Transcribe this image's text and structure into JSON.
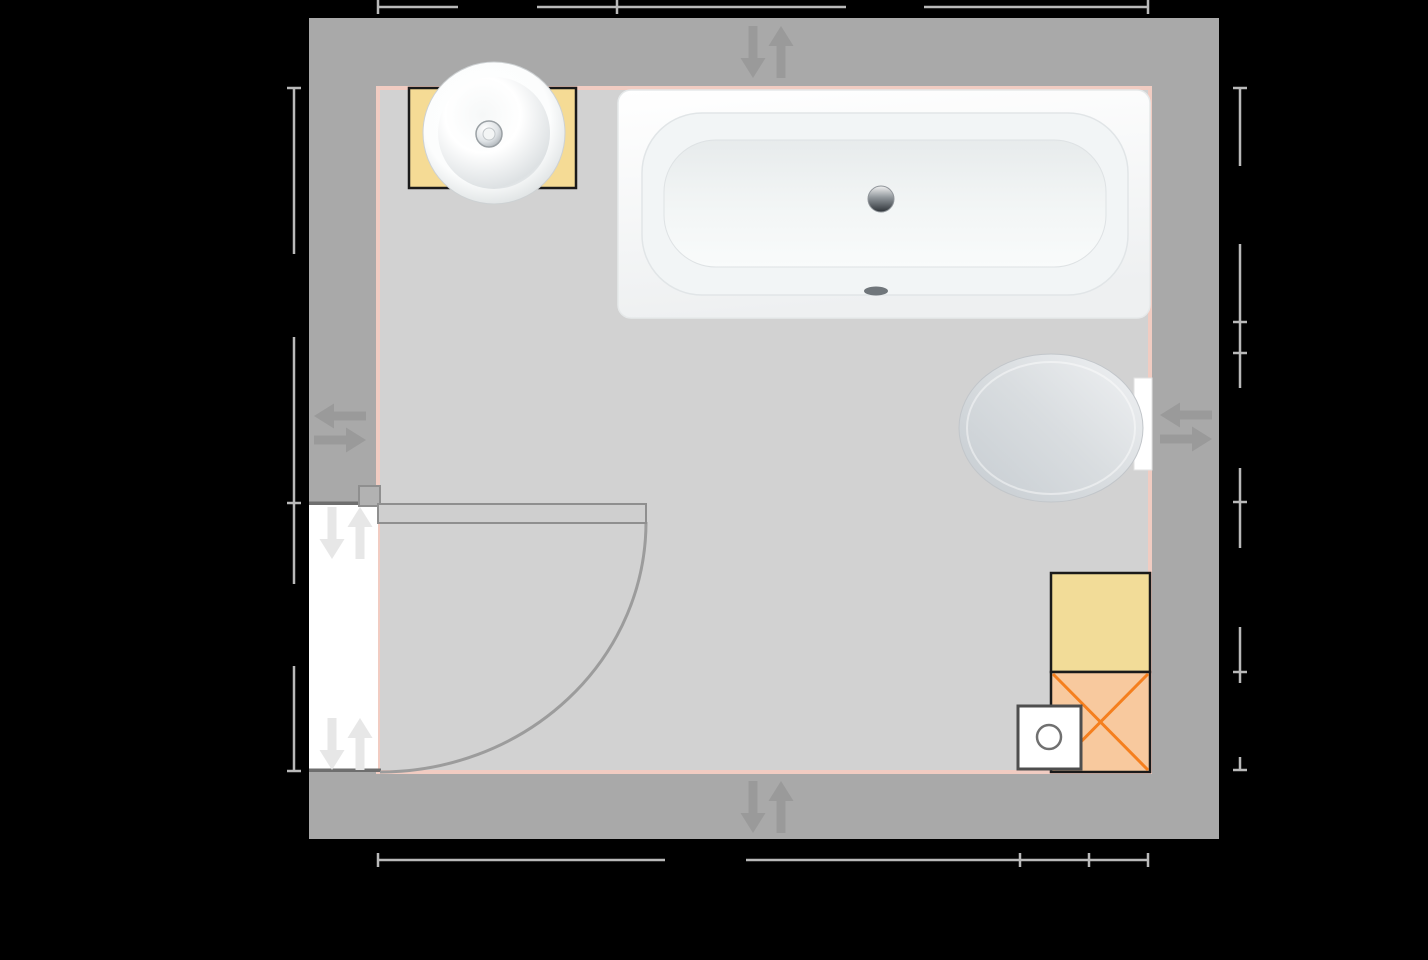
{
  "scene": {
    "type": "bathroom-floor-plan",
    "background": "#000000",
    "visible_text": ""
  },
  "colors": {
    "wall": "#a9a9a9",
    "floor": "#d2d2d2",
    "room_outline": "#f1ccc2",
    "opening": "#ffffff",
    "lintel": "#6e6e6e",
    "fixture_border": "#1a1a1a",
    "cabinet_yellow": "#f5db95",
    "shower_yellow": "#f2dc98",
    "orange_fill": "#f8c99e",
    "orange_cross": "#f57f1e",
    "door_leaf": "#cfcfcf",
    "door_border": "#8f8f8f",
    "door_hinge": "#b2b2b2",
    "door_swing": "#9c9c9c",
    "dimension": "#b9b9b9",
    "wall_arrow": "#9a9a9a",
    "opening_arrow": "#e7e7e7",
    "tank_white": "#ffffff",
    "drain_box_border": "#4e4e4e",
    "drain_circle": "#707070",
    "overflow_dark": "#70767b"
  },
  "fixtures": [
    {
      "id": "washbasin",
      "kind": "round-countertop-basin"
    },
    {
      "id": "vanity-cabinet",
      "kind": "cabinet"
    },
    {
      "id": "bathtub",
      "kind": "bathtub"
    },
    {
      "id": "toilet",
      "kind": "wall-hung-toilet"
    },
    {
      "id": "storage-unit",
      "kind": "cabinet"
    },
    {
      "id": "cross-marked-unit",
      "kind": "unit-with-x-cross"
    },
    {
      "id": "floor-drain-box",
      "kind": "box-with-circle"
    },
    {
      "id": "door",
      "kind": "hinged-door"
    }
  ],
  "dimensions": {
    "color": "#b9b9b9",
    "line_width": 2.5,
    "tick_half_length": 7,
    "chains": [
      {
        "name": "top",
        "orientation": "h",
        "pos": 7,
        "ticks": [
          378,
          617,
          1148
        ],
        "segments": [
          [
            378,
            458
          ],
          [
            537,
            846
          ],
          [
            924,
            1148
          ]
        ]
      },
      {
        "name": "left",
        "orientation": "v",
        "pos": 294,
        "ticks": [
          88,
          503,
          771
        ],
        "segments": [
          [
            88,
            254
          ],
          [
            337,
            584
          ],
          [
            666,
            771
          ]
        ]
      },
      {
        "name": "right",
        "orientation": "v",
        "pos": 1240,
        "ticks": [
          88,
          322,
          353,
          502,
          672,
          770
        ],
        "segments": [
          [
            88,
            166
          ],
          [
            244,
            388
          ],
          [
            468,
            548
          ],
          [
            627,
            683
          ],
          [
            757,
            770
          ]
        ]
      },
      {
        "name": "bottom",
        "orientation": "h",
        "pos": 860,
        "ticks": [
          378,
          1020,
          1089,
          1148
        ],
        "segments": [
          [
            378,
            665
          ],
          [
            746,
            1148
          ]
        ]
      }
    ]
  },
  "flow_arrows": {
    "geometry": {
      "length": 52,
      "shaft_width": 9,
      "head_width": 25,
      "head_length": 20,
      "pair_offset_vertical": 14,
      "pair_offset_horizontal": 12
    },
    "pairs": [
      {
        "name": "top-wall",
        "type": "vertical",
        "cx": 767,
        "cy": 52,
        "color_key": "wall_arrow"
      },
      {
        "name": "bottom-wall",
        "type": "vertical",
        "cx": 767,
        "cy": 807,
        "color_key": "wall_arrow"
      },
      {
        "name": "left-wall",
        "type": "horizontal",
        "cx": 340,
        "cy": 428,
        "color_key": "wall_arrow"
      },
      {
        "name": "right-wall",
        "type": "horizontal",
        "cx": 1186,
        "cy": 427,
        "color_key": "wall_arrow"
      },
      {
        "name": "door-opening-top",
        "type": "vertical",
        "cx": 346,
        "cy": 533,
        "color_key": "opening_arrow"
      },
      {
        "name": "door-opening-bottom",
        "type": "vertical",
        "cx": 346,
        "cy": 744,
        "color_key": "opening_arrow"
      }
    ]
  }
}
